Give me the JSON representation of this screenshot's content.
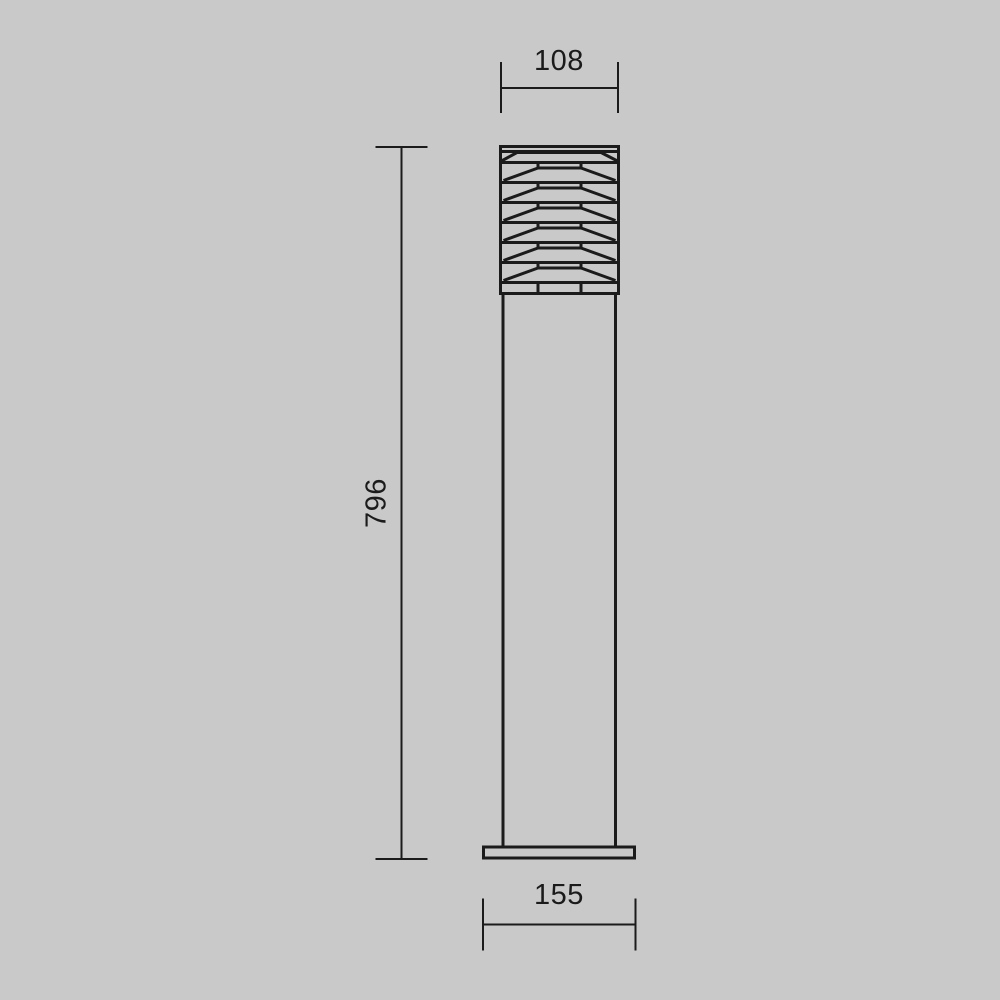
{
  "colors": {
    "background": "#c9c9c9",
    "line": "#1b1b1b"
  },
  "drawing": {
    "name": "bollard-light-dimension-drawing",
    "view": "front",
    "dimensions": {
      "head_width": "108",
      "overall_height": "796",
      "base_width": "155"
    }
  }
}
